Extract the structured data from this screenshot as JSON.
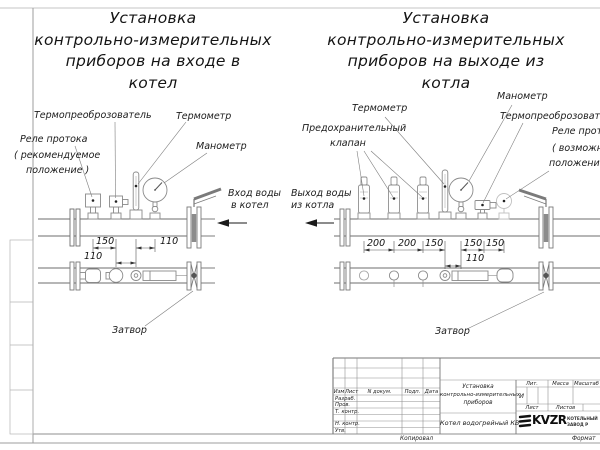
{
  "left": {
    "title": [
      "Установка",
      "контрольно-измерительных",
      "приборов на входе в",
      "котел"
    ],
    "labels": {
      "transducer": "Термопреоброзователь",
      "thermometer": "Термометр",
      "manometer": "Манометр",
      "relay1": "Реле протока",
      "relay2": "( рекомендуемое",
      "relay3": "положение )",
      "flow1": "Вход воды",
      "flow2": "в котел",
      "valve": "Затвор"
    },
    "dims": {
      "a": "150",
      "b": "110",
      "c": "110"
    }
  },
  "right": {
    "title": [
      "Установка",
      "контрольно-измерительных",
      "приборов на выходе из",
      "котла"
    ],
    "labels": {
      "thermometer": "Термометр",
      "manometer": "Манометр",
      "transducer": "Термопреоброзователь",
      "safety1": "Предохранительный",
      "safety2": "клапан",
      "relay1": "Реле протока",
      "relay2": "( возможное",
      "relay3": "положение )",
      "flow1": "Выход воды",
      "flow2": "из котла",
      "valve": "Затвор"
    },
    "dims": {
      "a": "200",
      "b": "200",
      "c": "150",
      "d": "150",
      "e": "150",
      "f": "110"
    }
  },
  "stamp": {
    "cols": [
      "Изм",
      "Лист",
      "N докум.",
      "Подп.",
      "Дата"
    ],
    "rows": [
      "Разраб.",
      "Пров.",
      "Т. контр.",
      "Н. контр.",
      "Утв."
    ],
    "doc_title": [
      "Установка",
      "контрольно-измерительных",
      "приборов"
    ],
    "product": "Котел водогрейный КВ",
    "lit_label": "Лит.",
    "mass_label": "Масса",
    "scale_label": "Масштаб",
    "lit_value": "И",
    "sheet_label": "Лист",
    "sheets_label": "Листов",
    "logo_text": "KVZR",
    "logo_sub1": "КОТЕЛЬНЫЙ",
    "logo_sub2": "ЗАВОД Р",
    "copied": "Копировал",
    "format": "Формат"
  }
}
